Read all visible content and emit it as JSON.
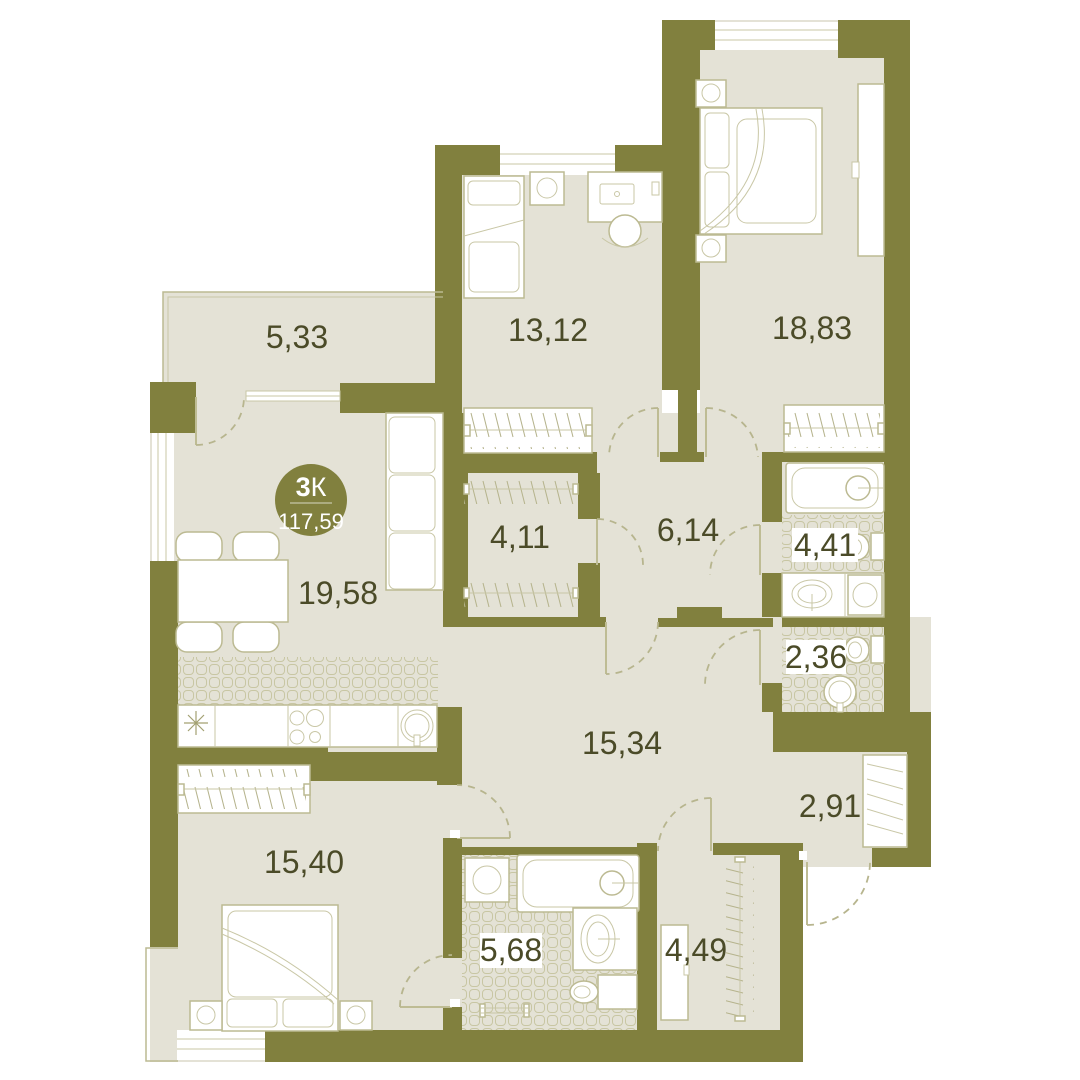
{
  "plan": {
    "type_badge": {
      "rooms_count": "3",
      "rooms_letter": "К",
      "total_area": "117,59"
    },
    "rooms": [
      {
        "id": "loggia",
        "area": "5,33"
      },
      {
        "id": "children-room",
        "area": "13,12"
      },
      {
        "id": "bedroom-main",
        "area": "18,83"
      },
      {
        "id": "walkin-closet",
        "area": "4,11"
      },
      {
        "id": "inner-hall",
        "area": "6,14"
      },
      {
        "id": "bathroom-main",
        "area": "4,41"
      },
      {
        "id": "wc",
        "area": "2,36"
      },
      {
        "id": "kitchen-living",
        "area": "19,58"
      },
      {
        "id": "hallway",
        "area": "15,34"
      },
      {
        "id": "entry-corridor",
        "area": "2,91"
      },
      {
        "id": "bedroom-second",
        "area": "15,40"
      },
      {
        "id": "bathroom-ensuite",
        "area": "5,68"
      },
      {
        "id": "closet-entry",
        "area": "4,49"
      }
    ],
    "colors": {
      "wall": "#81803E",
      "floor": "#E4E2D6",
      "furniture_line": "#BCBA92",
      "label_text": "#4B4B28",
      "badge_fill": "#81803E"
    }
  }
}
